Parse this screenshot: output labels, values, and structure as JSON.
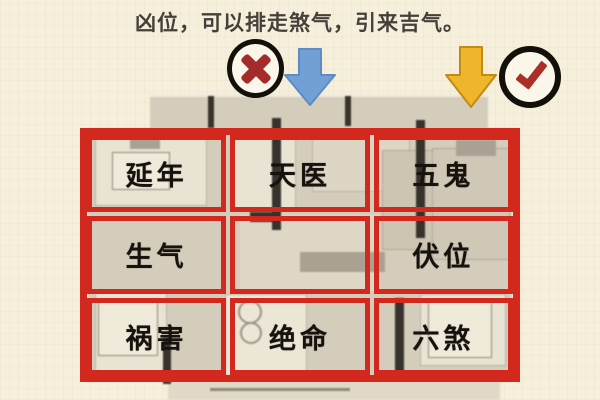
{
  "title": "凶位，可以排走煞气，引来吉气。",
  "icons": {
    "wrong_badge": "cross-in-circle",
    "wrong_arrow": "blue-down-arrow",
    "right_arrow": "yellow-down-arrow",
    "right_badge": "check-in-circle"
  },
  "grid": {
    "rows": [
      {
        "cells": [
          {
            "label": "延年"
          },
          {
            "label": "天医"
          },
          {
            "label": "五鬼"
          }
        ]
      },
      {
        "cells": [
          {
            "label": "生气"
          },
          {
            "label": ""
          },
          {
            "label": "伏位"
          }
        ]
      },
      {
        "cells": [
          {
            "label": "祸害"
          },
          {
            "label": "绝命"
          },
          {
            "label": "六煞"
          }
        ]
      }
    ]
  },
  "colors": {
    "background": "#f5efdb",
    "grid_red": "#d3281d",
    "title_text": "#45403a",
    "label_text": "#16120d",
    "blue_arrow": "#72a0d6",
    "yellow_arrow": "#efb52b",
    "circle_ring": "#121008",
    "cross_red": "#a42a2c",
    "check_red": "#ab2e28",
    "floorplan_gray": "#d4cdbc"
  }
}
